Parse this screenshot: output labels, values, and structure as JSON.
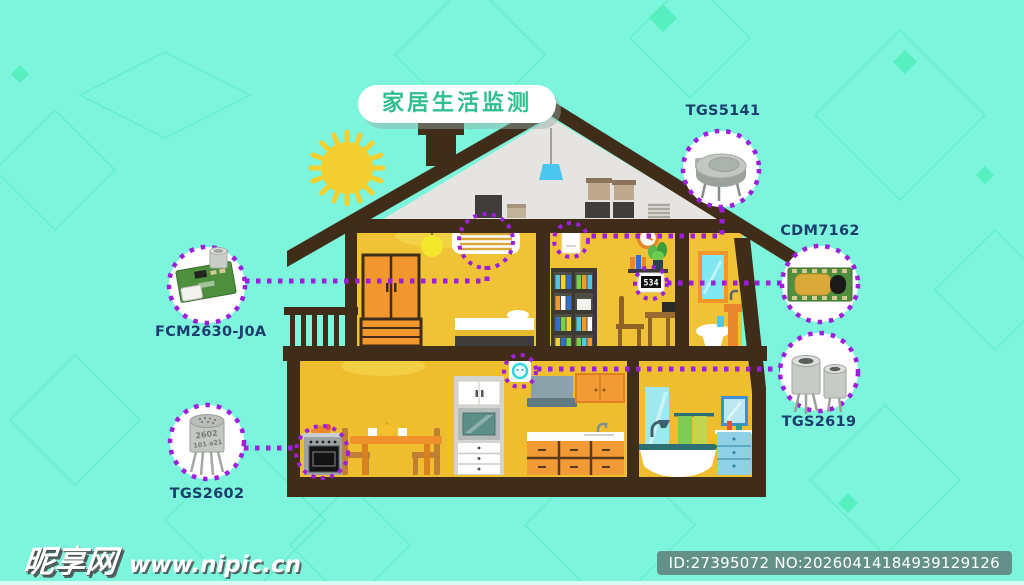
{
  "title": "家居生活监测",
  "sensors": {
    "tgs5141": {
      "label": "TGS5141"
    },
    "cdm7162": {
      "label": "CDM7162"
    },
    "tgs2619": {
      "label": "TGS2619"
    },
    "fcm2630": {
      "label": "FCM2630-J0A"
    },
    "tgs2602": {
      "label": "TGS2602",
      "marking_line1": "2602",
      "marking_line2": "101 a21"
    }
  },
  "devices": {
    "co2_display": "534"
  },
  "watermark": {
    "site_name": "昵享网",
    "site_url": "www.nipic.cn"
  },
  "footer": {
    "id_text": "ID:27395072 NO:20260414184939129126"
  },
  "colors": {
    "background": "#7DF4DC",
    "accent_purple": "#9D1EDB",
    "label_navy": "#1C3E6E",
    "title_green": "#2FBF8E",
    "wall_yellow": "#EFC335",
    "structure_brown": "#3F2D1A"
  }
}
